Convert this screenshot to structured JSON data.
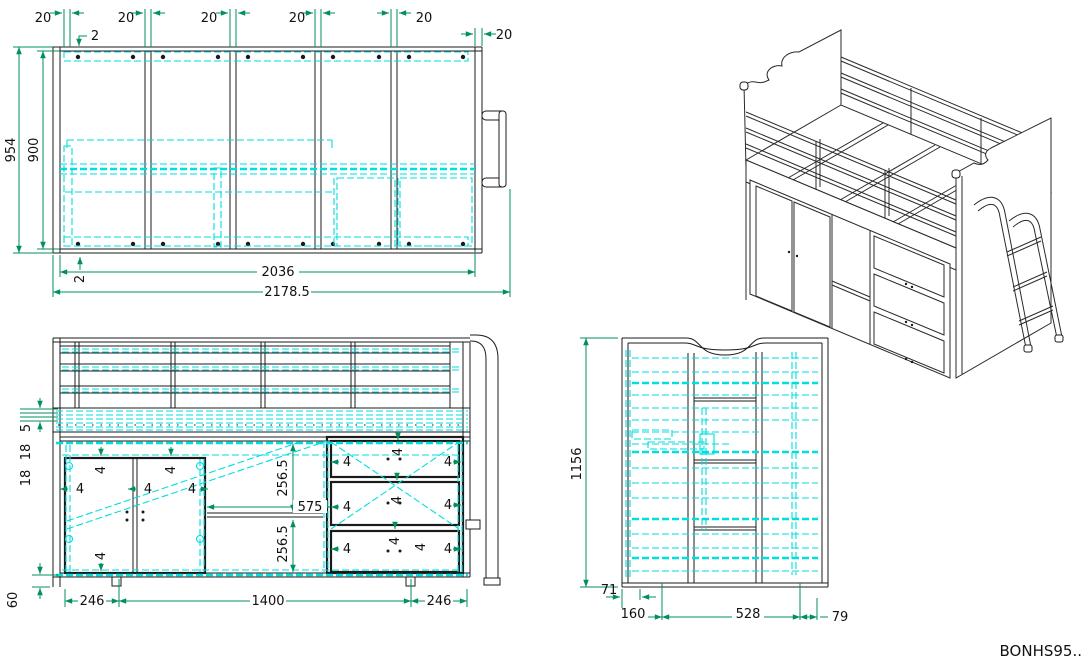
{
  "drawing": {
    "code": "BONHS95..",
    "colors": {
      "outline": "#1b1b1b",
      "dimension": "#008f5d",
      "highlight": "#00dede",
      "background": "#ffffff"
    }
  },
  "views": {
    "top": {
      "label": "top-view",
      "dims": {
        "slat_spacing": "20",
        "edge_gap": "2",
        "depth_total": "954",
        "depth_inner": "900",
        "length_inner": "2036",
        "length_total": "2178.5"
      }
    },
    "front": {
      "label": "front-view",
      "dims": {
        "rail_gap": "5",
        "rail_step": "18",
        "panel": "4",
        "opening_height": "256.5",
        "opening_width": "575",
        "plinth": "60",
        "door_width": "246",
        "middle_width": "1400"
      }
    },
    "side": {
      "label": "side-view",
      "dims": {
        "height_total": "1156",
        "offset_front": "71",
        "depth_front": "160",
        "depth_middle": "528",
        "ladder_overhang": "79"
      }
    }
  }
}
